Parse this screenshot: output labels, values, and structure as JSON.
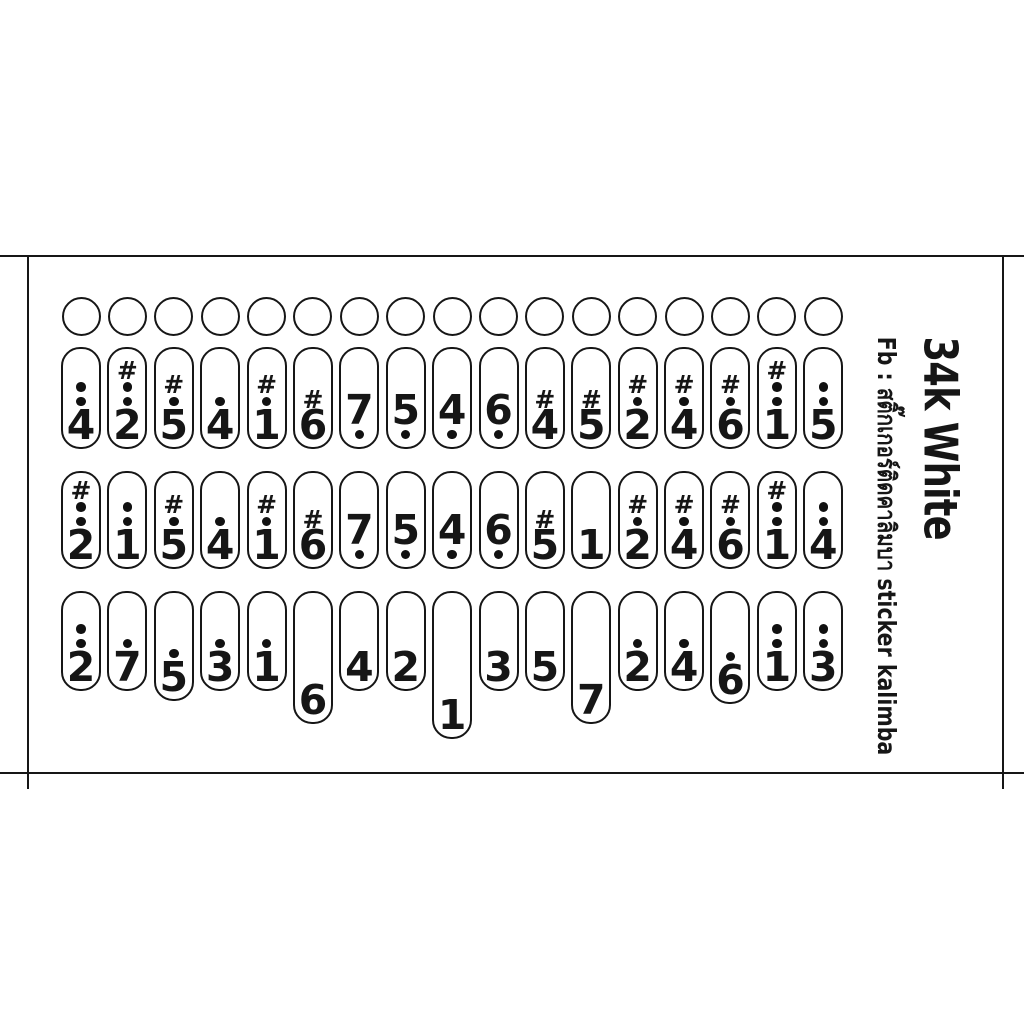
{
  "product": {
    "title": "34k White",
    "subtitle": "Fb : สติ๊กเกอร์ติดคาลิมบา sticker kalimba"
  },
  "colors": {
    "ink": "#161616",
    "background": "#ffffff"
  },
  "sheet": {
    "hole_count": 17,
    "row_base_heights_px": [
      102,
      98,
      100
    ],
    "rows": [
      {
        "id": "row-1",
        "stickers": [
          {
            "label": "4",
            "sharp": false,
            "dots_above": 2,
            "dots_below": 0,
            "extra_len": 0
          },
          {
            "label": "2",
            "sharp": true,
            "dots_above": 2,
            "dots_below": 0,
            "extra_len": 0
          },
          {
            "label": "5",
            "sharp": true,
            "dots_above": 1,
            "dots_below": 0,
            "extra_len": 0
          },
          {
            "label": "4",
            "sharp": false,
            "dots_above": 1,
            "dots_below": 0,
            "extra_len": 0
          },
          {
            "label": "1",
            "sharp": true,
            "dots_above": 1,
            "dots_below": 0,
            "extra_len": 0
          },
          {
            "label": "6",
            "sharp": true,
            "dots_above": 0,
            "dots_below": 0,
            "extra_len": 0
          },
          {
            "label": "7",
            "sharp": false,
            "dots_above": 0,
            "dots_below": 1,
            "extra_len": 0
          },
          {
            "label": "5",
            "sharp": false,
            "dots_above": 0,
            "dots_below": 1,
            "extra_len": 0
          },
          {
            "label": "4",
            "sharp": false,
            "dots_above": 0,
            "dots_below": 1,
            "extra_len": 0
          },
          {
            "label": "6",
            "sharp": false,
            "dots_above": 0,
            "dots_below": 1,
            "extra_len": 0
          },
          {
            "label": "4",
            "sharp": true,
            "dots_above": 0,
            "dots_below": 0,
            "extra_len": 0
          },
          {
            "label": "5",
            "sharp": true,
            "dots_above": 0,
            "dots_below": 0,
            "extra_len": 0
          },
          {
            "label": "2",
            "sharp": true,
            "dots_above": 1,
            "dots_below": 0,
            "extra_len": 0
          },
          {
            "label": "4",
            "sharp": true,
            "dots_above": 1,
            "dots_below": 0,
            "extra_len": 0
          },
          {
            "label": "6",
            "sharp": true,
            "dots_above": 1,
            "dots_below": 0,
            "extra_len": 0
          },
          {
            "label": "1",
            "sharp": true,
            "dots_above": 2,
            "dots_below": 0,
            "extra_len": 0
          },
          {
            "label": "5",
            "sharp": false,
            "dots_above": 2,
            "dots_below": 0,
            "extra_len": 0
          }
        ]
      },
      {
        "id": "row-2",
        "stickers": [
          {
            "label": "2",
            "sharp": true,
            "dots_above": 2,
            "dots_below": 0,
            "extra_len": 0
          },
          {
            "label": "1",
            "sharp": false,
            "dots_above": 2,
            "dots_below": 0,
            "extra_len": 0
          },
          {
            "label": "5",
            "sharp": true,
            "dots_above": 1,
            "dots_below": 0,
            "extra_len": 0
          },
          {
            "label": "4",
            "sharp": false,
            "dots_above": 1,
            "dots_below": 0,
            "extra_len": 0
          },
          {
            "label": "1",
            "sharp": true,
            "dots_above": 1,
            "dots_below": 0,
            "extra_len": 0
          },
          {
            "label": "6",
            "sharp": true,
            "dots_above": 0,
            "dots_below": 0,
            "extra_len": 0
          },
          {
            "label": "7",
            "sharp": false,
            "dots_above": 0,
            "dots_below": 1,
            "extra_len": 0
          },
          {
            "label": "5",
            "sharp": false,
            "dots_above": 0,
            "dots_below": 1,
            "extra_len": 0
          },
          {
            "label": "4",
            "sharp": false,
            "dots_above": 0,
            "dots_below": 1,
            "extra_len": 0
          },
          {
            "label": "6",
            "sharp": false,
            "dots_above": 0,
            "dots_below": 1,
            "extra_len": 0
          },
          {
            "label": "5",
            "sharp": true,
            "dots_above": 0,
            "dots_below": 0,
            "extra_len": 0
          },
          {
            "label": "1",
            "sharp": false,
            "dots_above": 0,
            "dots_below": 0,
            "extra_len": 0
          },
          {
            "label": "2",
            "sharp": true,
            "dots_above": 1,
            "dots_below": 0,
            "extra_len": 0
          },
          {
            "label": "4",
            "sharp": true,
            "dots_above": 1,
            "dots_below": 0,
            "extra_len": 0
          },
          {
            "label": "6",
            "sharp": true,
            "dots_above": 1,
            "dots_below": 0,
            "extra_len": 0
          },
          {
            "label": "1",
            "sharp": true,
            "dots_above": 2,
            "dots_below": 0,
            "extra_len": 0
          },
          {
            "label": "4",
            "sharp": false,
            "dots_above": 2,
            "dots_below": 0,
            "extra_len": 0
          }
        ]
      },
      {
        "id": "row-3",
        "stickers": [
          {
            "label": "2",
            "sharp": false,
            "dots_above": 2,
            "dots_below": 0,
            "extra_len": 0
          },
          {
            "label": "7",
            "sharp": false,
            "dots_above": 1,
            "dots_below": 0,
            "extra_len": 0
          },
          {
            "label": "5",
            "sharp": false,
            "dots_above": 1,
            "dots_below": 0,
            "extra_len": 10
          },
          {
            "label": "3",
            "sharp": false,
            "dots_above": 1,
            "dots_below": 0,
            "extra_len": 0
          },
          {
            "label": "1",
            "sharp": false,
            "dots_above": 1,
            "dots_below": 0,
            "extra_len": 0
          },
          {
            "label": "6",
            "sharp": false,
            "dots_above": 0,
            "dots_below": 0,
            "extra_len": 33
          },
          {
            "label": "4",
            "sharp": false,
            "dots_above": 0,
            "dots_below": 0,
            "extra_len": 0
          },
          {
            "label": "2",
            "sharp": false,
            "dots_above": 0,
            "dots_below": 0,
            "extra_len": 0
          },
          {
            "label": "1",
            "sharp": false,
            "dots_above": 0,
            "dots_below": 0,
            "extra_len": 48
          },
          {
            "label": "3",
            "sharp": false,
            "dots_above": 0,
            "dots_below": 0,
            "extra_len": 0
          },
          {
            "label": "5",
            "sharp": false,
            "dots_above": 0,
            "dots_below": 0,
            "extra_len": 0
          },
          {
            "label": "7",
            "sharp": false,
            "dots_above": 0,
            "dots_below": 0,
            "extra_len": 33
          },
          {
            "label": "2",
            "sharp": false,
            "dots_above": 1,
            "dots_below": 0,
            "extra_len": 0
          },
          {
            "label": "4",
            "sharp": false,
            "dots_above": 1,
            "dots_below": 0,
            "extra_len": 0
          },
          {
            "label": "6",
            "sharp": false,
            "dots_above": 1,
            "dots_below": 0,
            "extra_len": 13
          },
          {
            "label": "1",
            "sharp": false,
            "dots_above": 2,
            "dots_below": 0,
            "extra_len": 0
          },
          {
            "label": "3",
            "sharp": false,
            "dots_above": 2,
            "dots_below": 0,
            "extra_len": 0
          }
        ]
      }
    ]
  }
}
